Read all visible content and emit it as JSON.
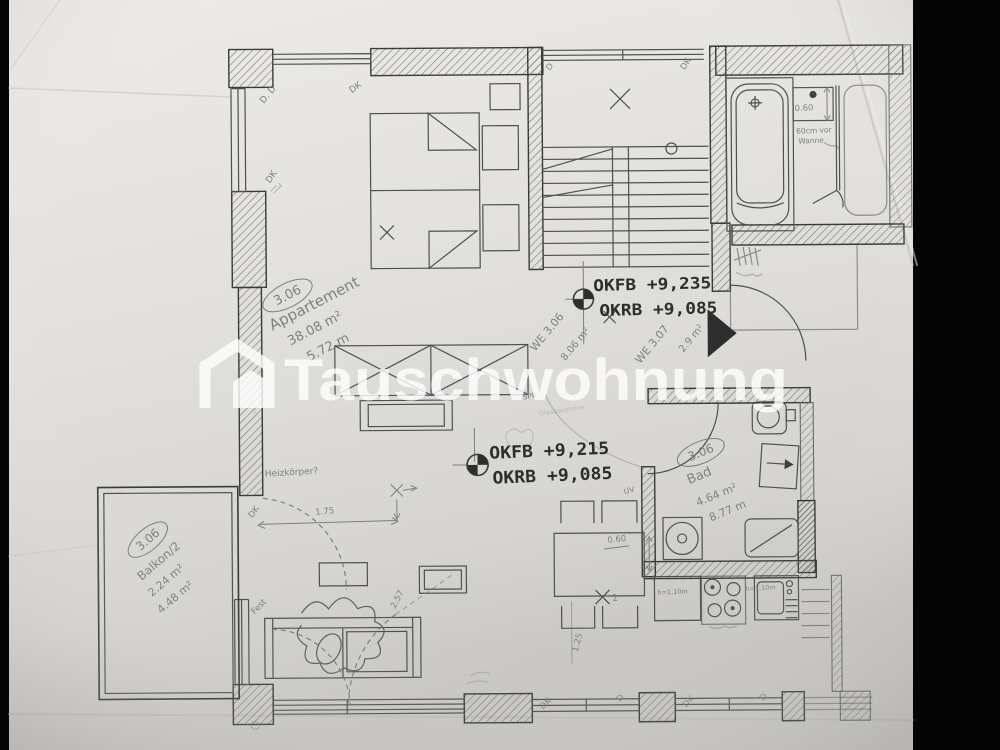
{
  "watermark": {
    "brand": "Tauschwohnung"
  },
  "levels": {
    "upper_okfb": "OKFB +9,235",
    "upper_okrb": "OKRB +9,085",
    "lower_okfb": "OKFB +9,215",
    "lower_okrb": "OKRB +9,085"
  },
  "rooms": {
    "apartment_id": "3.06",
    "apartment_name": "Appartement",
    "apartment_area": "38.08 m²",
    "apartment_len": "5.72 m",
    "bad_id": "3.06",
    "bad_name": "Bad",
    "bad_area": "4.64 m²",
    "bad_perimeter": "8.77 m",
    "balkon_id": "3.06",
    "balkon_name": "Balkon/2",
    "balkon_area_half": "2.24 m²",
    "balkon_area_full": "4.48 m²",
    "we306_label": "WE 3.06",
    "we306_area": "8.06 m²",
    "we307_label": "WE 3.07",
    "we307_area": "2.9 m²"
  },
  "annotations": {
    "heizkoerper": "Heizkörper?",
    "fest": "Fest",
    "spr": "SPR",
    "spr_note": "Glasbausteine",
    "tub_note_line1": "60cm vor",
    "tub_note_line2": "Wanne",
    "uv": "UV",
    "table_count": "2",
    "counter_height_left": "h=1,10m",
    "counter_height_right": "h=1,10m",
    "layer_note_1": "Cr",
    "layer_note_2": "st"
  },
  "dimensions": {
    "bath_niche": "0.60",
    "table_width": "0.60",
    "table_length": "1.25",
    "radiator_gap": "1.75",
    "balcony_door": "2.57"
  },
  "openings": {
    "bedroom_top_corner": "D. D",
    "bedroom_top": "DK",
    "bedroom_left": "DK",
    "living_left_door": "DK",
    "stair_window_left": "D",
    "stair_window_right": "DK",
    "bottom_window_1_left": "DK",
    "bottom_window_1_right": "D",
    "bottom_window_2_left": "DK",
    "bottom_window_2_right": "D"
  }
}
